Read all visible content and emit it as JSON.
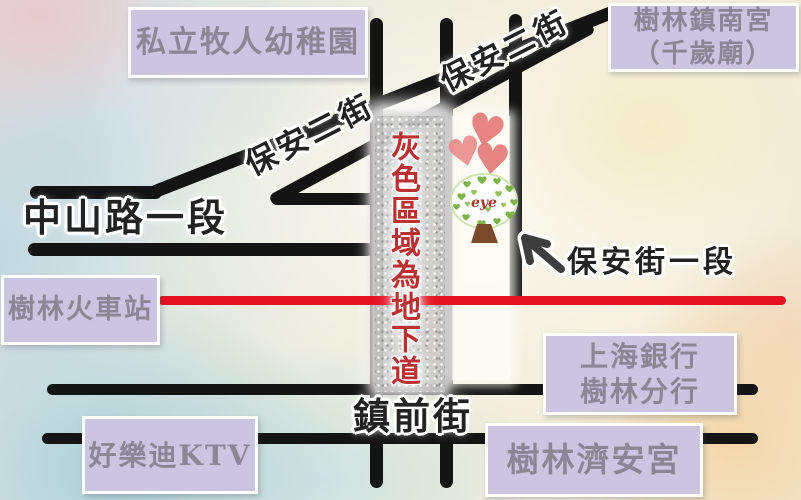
{
  "places": {
    "kindergarten": "私立牧人幼稚園",
    "temple_north": {
      "line1": "樹林鎮南宮",
      "line2": "（千歲廟）"
    },
    "train_station": "樹林火車站",
    "bank": {
      "line1": "上海銀行",
      "line2": "樹林分行"
    },
    "ktv": "好樂迪KTV",
    "temple_jian": "樹林濟安宮"
  },
  "streets": {
    "baoan_2nd_upper": "保安二街",
    "baoan_2nd_lower": "保安二街",
    "zhongshan_rd": "中山路一段",
    "baoan_1st": "保安街一段",
    "zhenqian_st": "鎮前街"
  },
  "underpass_note": "灰色區域為地下道",
  "tree": {
    "label": "eye"
  },
  "colors": {
    "label_box_fill": "#ccc5e2",
    "label_text": "#8b8695",
    "road_black": "#141414",
    "railway_red": "#e41222",
    "underpass_gray": "#ccc9ca",
    "note_red": "#bb3030",
    "heart_pink": "#e2716e",
    "tree_green": "#7db34a",
    "trunk_brown": "#7a4a2b"
  }
}
